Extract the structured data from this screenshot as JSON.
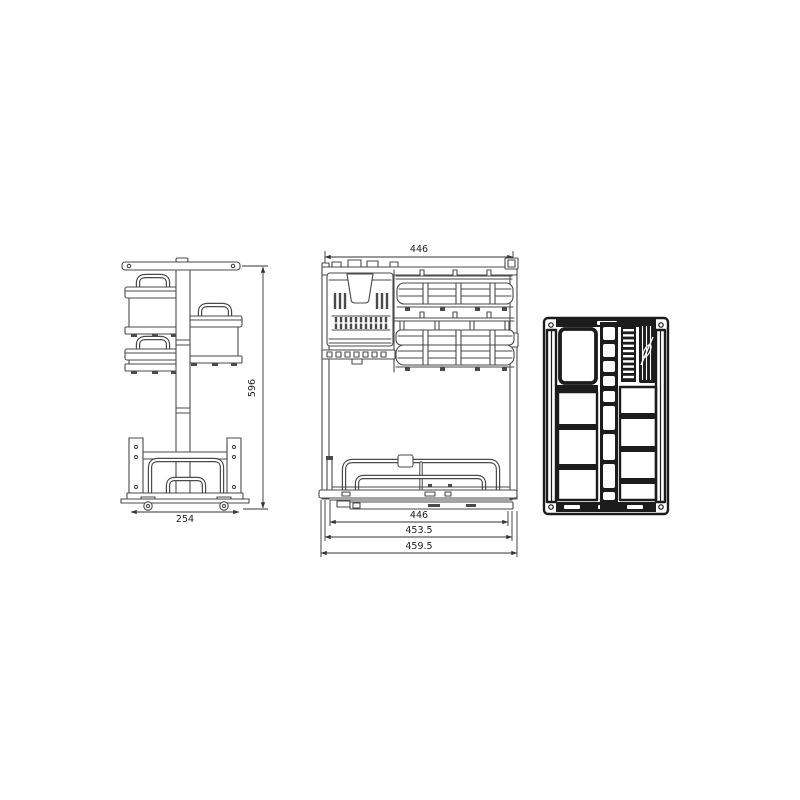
{
  "diagram": {
    "kind": "technical-line-drawing",
    "subject": "pull-out cabinet basket organizer shown in three orthographic views",
    "views": [
      {
        "id": "side-view"
      },
      {
        "id": "front-view"
      },
      {
        "id": "plan-view"
      }
    ],
    "dimensions": {
      "side_height": "596",
      "side_base_width": "254",
      "front_top_width": "446",
      "front_inner_width": "446",
      "front_mid_width": "453.5",
      "front_outer_width": "459.5"
    },
    "colors": {
      "background": "#ffffff",
      "line": "#4a4a4a",
      "line_dark": "#1c1c1c",
      "dimension": "#333333"
    }
  }
}
